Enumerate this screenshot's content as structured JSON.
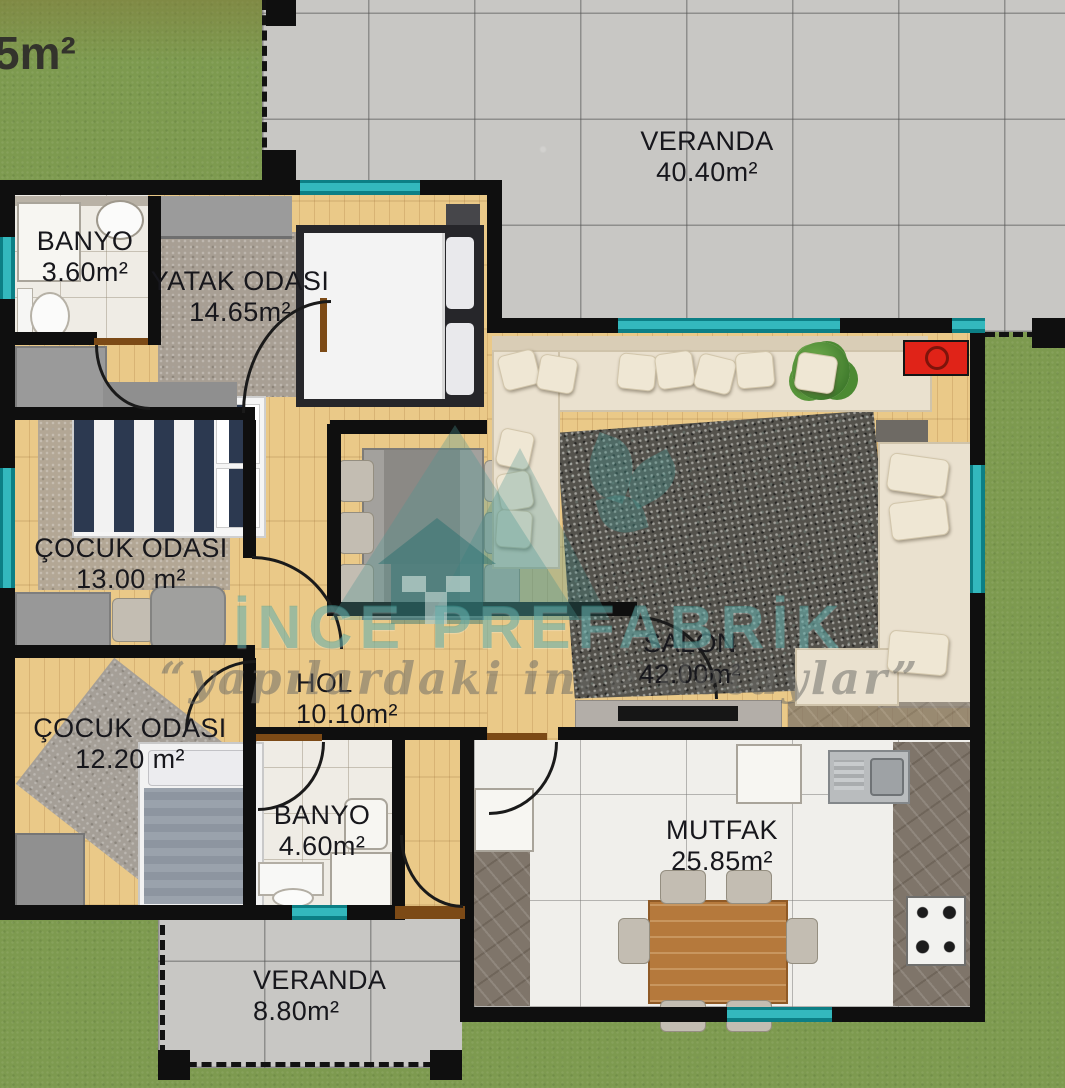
{
  "meta": {
    "corner_area_label": "5m²"
  },
  "watermark": {
    "brand": "İNCE PREFABRİK",
    "tagline": "“yapılardaki ince detaylar”"
  },
  "rooms": {
    "veranda_top": {
      "name": "VERANDA",
      "area": "40.40m²"
    },
    "banyo_top": {
      "name": "BANYO",
      "area": "3.60m²"
    },
    "yatak_odasi": {
      "name": "YATAK ODASI",
      "area": "14.65m²"
    },
    "cocuk_odasi_1": {
      "name": "ÇOCUK ODASI",
      "area": "13.00 m²"
    },
    "cocuk_odasi_2": {
      "name": "ÇOCUK ODASI",
      "area": "12.20 m²"
    },
    "hol": {
      "name": "HOL",
      "area": "10.10m²"
    },
    "banyo_alt": {
      "name": "BANYO",
      "area": "4.60m²"
    },
    "salon": {
      "name": "SALON",
      "area": "42.00m²"
    },
    "mutfak": {
      "name": "MUTFAK",
      "area": "25.85m²"
    },
    "veranda_alt": {
      "name": "VERANDA",
      "area": "8.80m²"
    }
  },
  "colors": {
    "accent_teal": "#23a6ab",
    "wall_black": "#0f0f0f",
    "grass_green": "#7d9a4f",
    "wood_floor": "#eac988",
    "veranda_tile": "#c8c7c4",
    "appliance_red": "#e02318"
  }
}
